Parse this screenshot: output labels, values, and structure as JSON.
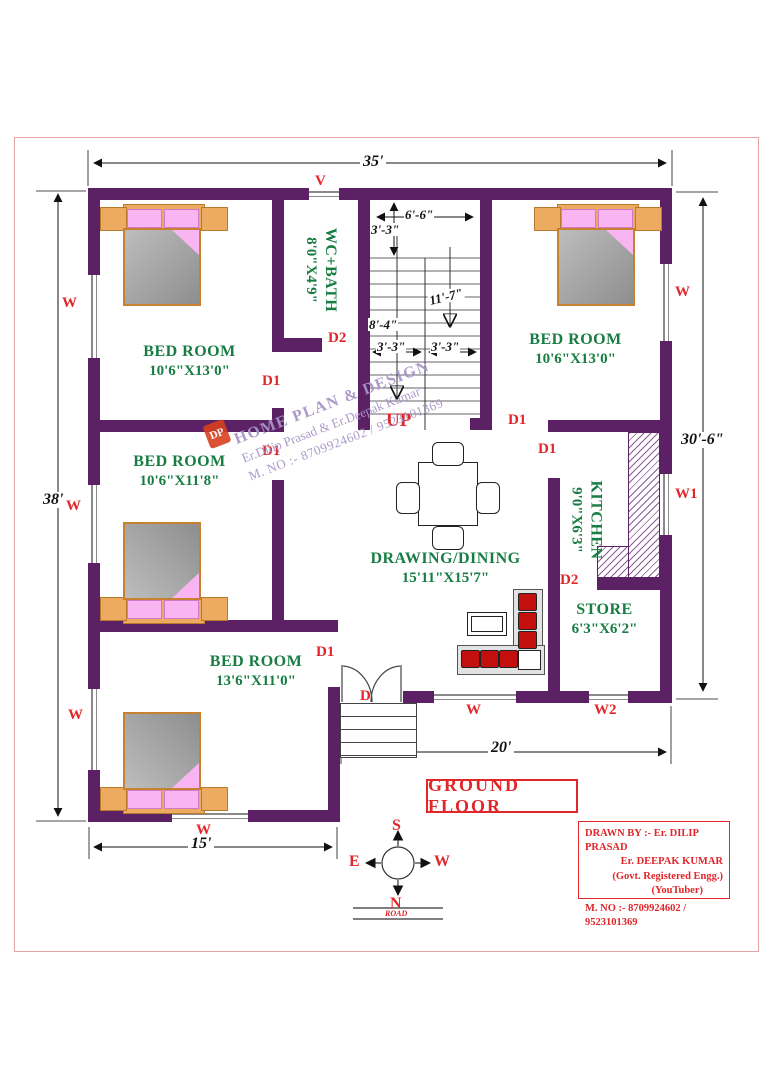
{
  "colors": {
    "wall": "#5b2164",
    "accent_red": "#e2262a",
    "room_green": "#177d42",
    "watermark_purple": "#a795c8",
    "dim_black": "#111111"
  },
  "title": {
    "text": "GROUND FLOOR"
  },
  "dimensions": {
    "top": "35'",
    "left": "38'",
    "right": "30'-6\"",
    "bottom": "20'",
    "bottom_left": "15'"
  },
  "rooms": {
    "bedroom_top_left": {
      "name": "BED ROOM",
      "size": "10'6\"X13'0\""
    },
    "bedroom_top_right": {
      "name": "BED ROOM",
      "size": "10'6\"X13'0\""
    },
    "bedroom_mid_left": {
      "name": "BED ROOM",
      "size": "10'6\"X11'8\""
    },
    "bedroom_bottom_left": {
      "name": "BED ROOM",
      "size": "13'6\"X11'0\""
    },
    "wc_bath": {
      "name": "WC+BATH",
      "size": "8'0\"X4'9\""
    },
    "kitchen": {
      "name": "KITCHEN",
      "size": "9'0\"X6'3\""
    },
    "store": {
      "name": "STORE",
      "size": "6'3\"X6'2\""
    },
    "drawing_dining": {
      "name": "DRAWING/DINING",
      "size": "15'11\"X15'7\""
    }
  },
  "stairs": {
    "up": "UP",
    "width": "6'-6\"",
    "landing": "3'-3\"",
    "flight": "11'-7\"",
    "left_run": "8'-4\"",
    "run1": "3'-3\"",
    "run2": "3'-3\""
  },
  "openings": {
    "vent": "V",
    "window": "W",
    "window1": "W1",
    "window2": "W2",
    "door": "D",
    "door1": "D1",
    "door2": "D2"
  },
  "compass": {
    "north": "N",
    "south": "S",
    "east": "E",
    "west": "W"
  },
  "road": {
    "label": "ROAD"
  },
  "watermark": {
    "logo": "DP",
    "line1": "HOME PLAN & DESIGN",
    "line2": "Er.Dilip Prasad & Er.Deepak Kumar",
    "line3": "M. NO :- 8709924602 / 9523101369"
  },
  "title_block": {
    "line1": "DRAWN BY :- Er. DILIP PRASAD",
    "line2": "Er. DEEPAK KUMAR",
    "line3": "(Govt. Registered Engg.)",
    "line4": "(YouTuber)",
    "line5": "M. NO :- 8709924602 / 9523101369"
  }
}
